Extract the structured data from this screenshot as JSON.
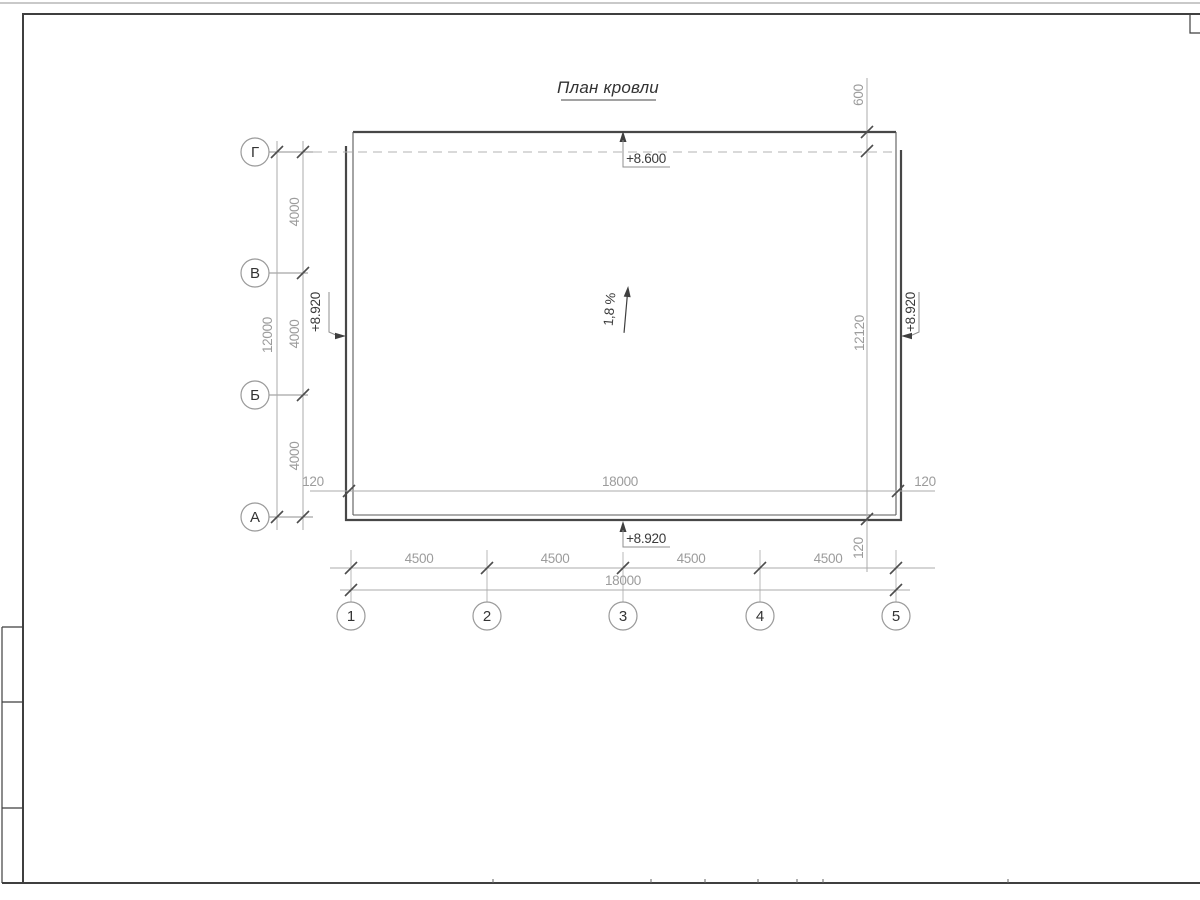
{
  "sheet": {
    "title": "План кровли"
  },
  "axes": {
    "vertical": [
      {
        "label": "Г"
      },
      {
        "label": "В"
      },
      {
        "label": "Б"
      },
      {
        "label": "А"
      }
    ],
    "horizontal": [
      {
        "label": "1"
      },
      {
        "label": "2"
      },
      {
        "label": "3"
      },
      {
        "label": "4"
      },
      {
        "label": "5"
      }
    ]
  },
  "elevations": {
    "top": "+8.600",
    "bottom": "+8.920",
    "left": "+8.920",
    "right": "+8.920"
  },
  "slope": {
    "label": "1,8 %"
  },
  "dims": {
    "left_total": "12000",
    "left_segments": [
      "4000",
      "4000",
      "4000"
    ],
    "top_right_offset": "600",
    "right_total": "12120",
    "right_overhang": "120",
    "roof_line_left": "120",
    "roof_line_total": "18000",
    "roof_line_right": "120",
    "bottom_segments": [
      "4500",
      "4500",
      "4500",
      "4500"
    ],
    "bottom_total": "18000"
  },
  "colors": {
    "outline": "#474747",
    "dim_line": "#ababab",
    "dim_text": "#9c9c9c",
    "dark_text": "#333333"
  }
}
